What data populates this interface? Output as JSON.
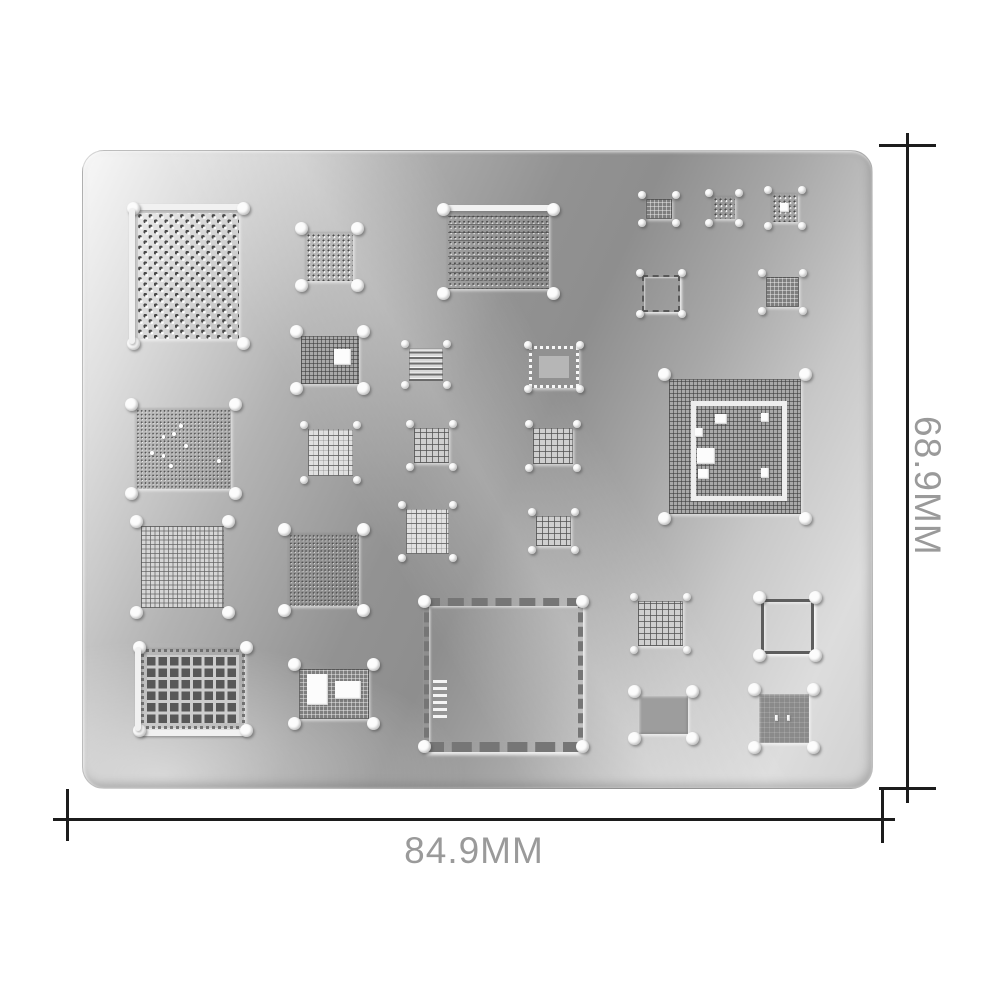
{
  "product": {
    "description": "metal BGA reballing stencil plate with chip footprint cutouts"
  },
  "dimensions": {
    "width_label": "84.9MM",
    "height_label": "68.9MM"
  },
  "colors": {
    "line": "#1c1c1c",
    "dim_text": "#9a9a9a",
    "plate_light": "#f8f8f8",
    "plate_dark": "#8e8e8e",
    "hole_dark": "#4a4a4a",
    "cutout_white": "#fbfbfb"
  },
  "stencil": {
    "chips": [
      {
        "name": "bga-large-diagonal",
        "x": 55,
        "y": 62,
        "w": 101,
        "h": 126,
        "pattern": "diag-dots",
        "edges": [
          "top",
          "left"
        ]
      },
      {
        "name": "bga-dot-grid-small",
        "x": 223,
        "y": 82,
        "w": 47,
        "h": 48,
        "pattern": "dotgrid"
      },
      {
        "name": "bga-ram-wide",
        "x": 365,
        "y": 63,
        "w": 101,
        "h": 75,
        "pattern": "ramdots",
        "edges": [
          "top"
        ]
      },
      {
        "name": "pad-tiny-1",
        "x": 563,
        "y": 48,
        "w": 26,
        "h": 20,
        "pattern": "grid-dark"
      },
      {
        "name": "pad-tiny-2",
        "x": 630,
        "y": 46,
        "w": 22,
        "h": 22,
        "pattern": "dotgrid"
      },
      {
        "name": "pad-tiny-3",
        "x": 689,
        "y": 43,
        "w": 26,
        "h": 28,
        "pattern": "dotgrid",
        "features": [
          {
            "type": "white",
            "x": 32,
            "y": 32,
            "w": 34,
            "h": 32
          }
        ]
      },
      {
        "name": "pad-hollow-dashed",
        "x": 559,
        "y": 124,
        "w": 34,
        "h": 33,
        "pattern": "hollow-dash"
      },
      {
        "name": "pad-grid-dark-small",
        "x": 683,
        "y": 126,
        "w": 33,
        "h": 30,
        "pattern": "grid-dark"
      },
      {
        "name": "cpu-grid-cutout",
        "x": 218,
        "y": 185,
        "w": 58,
        "h": 48,
        "pattern": "grid-mid",
        "features": [
          {
            "type": "white",
            "x": 57,
            "y": 27,
            "w": 29,
            "h": 33
          }
        ]
      },
      {
        "name": "pad-striped-small",
        "x": 326,
        "y": 197,
        "w": 34,
        "h": 33,
        "pattern": "stripes"
      },
      {
        "name": "pad-dotted-border",
        "x": 446,
        "y": 195,
        "w": 44,
        "h": 36,
        "pattern": "dotted-border",
        "features": [
          {
            "type": "panel",
            "x": 16,
            "y": 20,
            "w": 68,
            "h": 60
          }
        ]
      },
      {
        "name": "cpu-large-framed",
        "x": 586,
        "y": 228,
        "w": 132,
        "h": 135,
        "pattern": "grid-mid",
        "features": [
          {
            "type": "frame",
            "x": 17,
            "y": 16,
            "w": 65,
            "h": 67
          },
          {
            "type": "white",
            "x": 35,
            "y": 26,
            "w": 9,
            "h": 7
          },
          {
            "type": "white",
            "x": 20,
            "y": 36,
            "w": 6,
            "h": 7
          },
          {
            "type": "white",
            "x": 21,
            "y": 51,
            "w": 14,
            "h": 12
          },
          {
            "type": "white",
            "x": 22,
            "y": 67,
            "w": 8,
            "h": 7
          },
          {
            "type": "white",
            "x": 70,
            "y": 25,
            "w": 6,
            "h": 7
          },
          {
            "type": "white",
            "x": 70,
            "y": 66,
            "w": 6,
            "h": 7
          }
        ]
      },
      {
        "name": "nand-micro-dots",
        "x": 53,
        "y": 258,
        "w": 95,
        "h": 80,
        "pattern": "microdots",
        "features": [
          {
            "type": "dot",
            "x": 45,
            "y": 19,
            "w": 4,
            "h": 5
          },
          {
            "type": "dot",
            "x": 27,
            "y": 33,
            "w": 4,
            "h": 5
          },
          {
            "type": "dot",
            "x": 38,
            "y": 29,
            "w": 4,
            "h": 5
          },
          {
            "type": "dot",
            "x": 15,
            "y": 53,
            "w": 4,
            "h": 5
          },
          {
            "type": "dot",
            "x": 27,
            "y": 56,
            "w": 4,
            "h": 5
          },
          {
            "type": "dot",
            "x": 35,
            "y": 69,
            "w": 4,
            "h": 5
          },
          {
            "type": "dot",
            "x": 51,
            "y": 44,
            "w": 4,
            "h": 5
          },
          {
            "type": "dot",
            "x": 85,
            "y": 62,
            "w": 4,
            "h": 5
          }
        ]
      },
      {
        "name": "pad-grid-light",
        "x": 225,
        "y": 278,
        "w": 45,
        "h": 47,
        "pattern": "grid-coarse"
      },
      {
        "name": "pad-grid-1",
        "x": 331,
        "y": 277,
        "w": 35,
        "h": 35,
        "pattern": "grid"
      },
      {
        "name": "pad-grid-2",
        "x": 450,
        "y": 277,
        "w": 40,
        "h": 36,
        "pattern": "grid"
      },
      {
        "name": "pad-grid-fine",
        "x": 58,
        "y": 375,
        "w": 83,
        "h": 82,
        "pattern": "grid-fine"
      },
      {
        "name": "pad-micro-dots-2",
        "x": 206,
        "y": 383,
        "w": 70,
        "h": 72,
        "pattern": "microdots"
      },
      {
        "name": "pad-grid-light-2",
        "x": 323,
        "y": 358,
        "w": 43,
        "h": 45,
        "pattern": "grid-coarse"
      },
      {
        "name": "pad-grid-3",
        "x": 453,
        "y": 365,
        "w": 35,
        "h": 30,
        "pattern": "grid"
      },
      {
        "name": "pad-large-holes",
        "x": 58,
        "y": 498,
        "w": 92,
        "h": 68,
        "pattern": "holes",
        "edges": [
          "left",
          "bottom"
        ]
      },
      {
        "name": "connector-pads",
        "x": 216,
        "y": 518,
        "w": 70,
        "h": 50,
        "pattern": "grid-dark",
        "features": [
          {
            "type": "white",
            "x": 12,
            "y": 10,
            "w": 30,
            "h": 62
          },
          {
            "type": "white",
            "x": 52,
            "y": 24,
            "w": 36,
            "h": 36
          }
        ]
      },
      {
        "name": "frame-perimeter-large",
        "x": 341,
        "y": 447,
        "w": 149,
        "h": 136,
        "pattern": "perimeter",
        "features": [
          {
            "type": "stripes",
            "x": 3,
            "y": 52,
            "w": 9,
            "h": 30
          }
        ]
      },
      {
        "name": "pad-grid-4",
        "x": 555,
        "y": 450,
        "w": 45,
        "h": 45,
        "pattern": "grid"
      },
      {
        "name": "pad-hollow-solid",
        "x": 678,
        "y": 448,
        "w": 47,
        "h": 49,
        "pattern": "hollow-solid"
      },
      {
        "name": "pad-solid-rect",
        "x": 556,
        "y": 545,
        "w": 49,
        "h": 38,
        "pattern": "solid"
      },
      {
        "name": "pad-solid-square",
        "x": 676,
        "y": 543,
        "w": 50,
        "h": 49,
        "pattern": "solid-dark",
        "features": [
          {
            "type": "white",
            "x": 32,
            "y": 42,
            "w": 6,
            "h": 14
          },
          {
            "type": "white",
            "x": 56,
            "y": 42,
            "w": 6,
            "h": 14
          }
        ]
      }
    ]
  }
}
